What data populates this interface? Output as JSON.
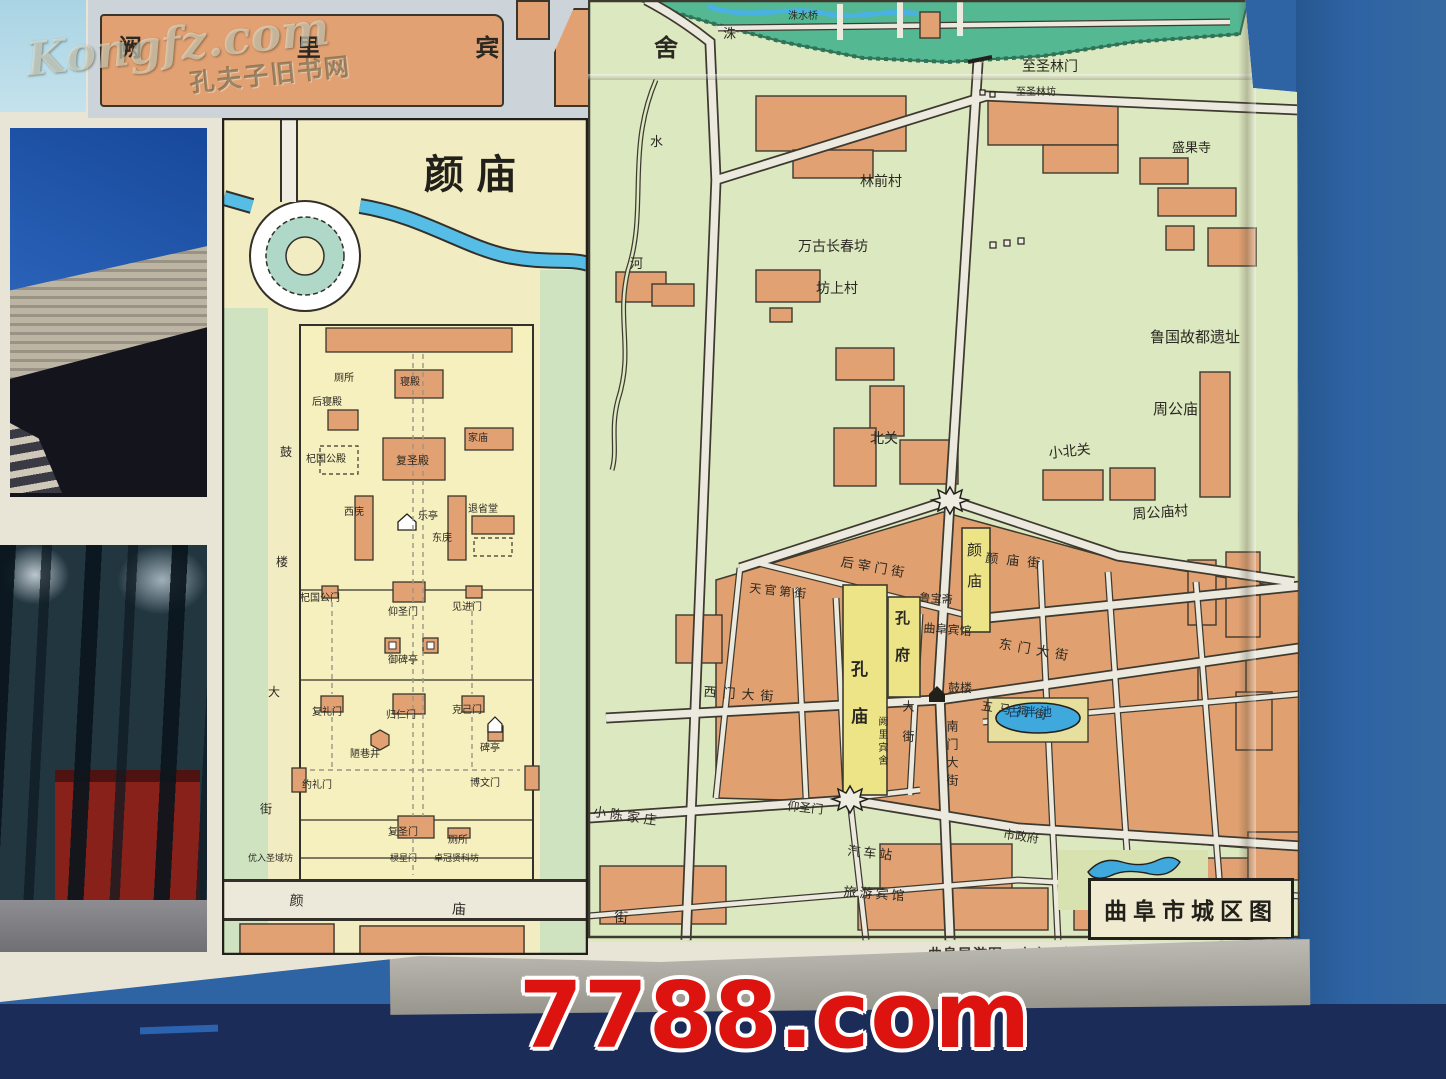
{
  "watermarks": {
    "bookstore": "Kongfz.com",
    "bookstore_sub": "孔夫子旧书网",
    "marketplace": "7788.com"
  },
  "hotel_inset": {
    "label": "阙  里  宾  舍"
  },
  "yanmiao_inset": {
    "title": "颜庙",
    "labels": [
      {
        "t": "厕所",
        "x": 334,
        "y": 374,
        "s": 10
      },
      {
        "t": "寝殿",
        "x": 400,
        "y": 378,
        "s": 10
      },
      {
        "t": "后寝殿",
        "x": 312,
        "y": 398,
        "s": 10
      },
      {
        "t": "家庙",
        "x": 468,
        "y": 434,
        "s": 10
      },
      {
        "t": "杞国公殿",
        "x": 306,
        "y": 455,
        "s": 10
      },
      {
        "t": "复圣殿",
        "x": 396,
        "y": 455,
        "s": 11
      },
      {
        "t": "西庑",
        "x": 344,
        "y": 508,
        "s": 10
      },
      {
        "t": "乐亭",
        "x": 418,
        "y": 512,
        "s": 10
      },
      {
        "t": "退省堂",
        "x": 468,
        "y": 505,
        "s": 10
      },
      {
        "t": "东庑",
        "x": 432,
        "y": 534,
        "s": 10
      },
      {
        "t": "杞国公门",
        "x": 300,
        "y": 594,
        "s": 10
      },
      {
        "t": "仰圣门",
        "x": 388,
        "y": 608,
        "s": 10
      },
      {
        "t": "见进门",
        "x": 452,
        "y": 603,
        "s": 10
      },
      {
        "t": "御碑亭",
        "x": 388,
        "y": 656,
        "s": 10
      },
      {
        "t": "复礼门",
        "x": 312,
        "y": 708,
        "s": 10
      },
      {
        "t": "归仁门",
        "x": 386,
        "y": 711,
        "s": 10
      },
      {
        "t": "克己门",
        "x": 452,
        "y": 706,
        "s": 10
      },
      {
        "t": "陋巷井",
        "x": 350,
        "y": 750,
        "s": 10
      },
      {
        "t": "碑亭",
        "x": 480,
        "y": 744,
        "s": 10
      },
      {
        "t": "约礼门",
        "x": 302,
        "y": 781,
        "s": 10
      },
      {
        "t": "博文门",
        "x": 470,
        "y": 779,
        "s": 10
      },
      {
        "t": "复圣门",
        "x": 388,
        "y": 828,
        "s": 10
      },
      {
        "t": "厕所",
        "x": 448,
        "y": 836,
        "s": 10
      },
      {
        "t": "优入圣域坊",
        "x": 248,
        "y": 855,
        "s": 9
      },
      {
        "t": "棂星门",
        "x": 390,
        "y": 855,
        "s": 9
      },
      {
        "t": "卓冠贤科坊",
        "x": 434,
        "y": 855,
        "s": 9
      },
      {
        "t": "颜 庙 街",
        "x": 290,
        "y": 894,
        "s": 14,
        "ls": 72,
        "r": 3
      },
      {
        "t": "鼓",
        "x": 280,
        "y": 446,
        "s": 12
      },
      {
        "t": "楼",
        "x": 276,
        "y": 556,
        "s": 12
      },
      {
        "t": "大",
        "x": 268,
        "y": 686,
        "s": 12
      },
      {
        "t": "街",
        "x": 260,
        "y": 803,
        "s": 12
      }
    ]
  },
  "city_map": {
    "title": "曲阜市城区图",
    "caption": "曲阜导游图　山东画报社编　准印号 2—019　定价0.65元",
    "labels": [
      {
        "t": "洙",
        "x": 723,
        "y": 28,
        "s": 13
      },
      {
        "t": "水",
        "x": 650,
        "y": 136,
        "s": 13
      },
      {
        "t": "河",
        "x": 630,
        "y": 258,
        "s": 13
      },
      {
        "t": "洙水桥",
        "x": 788,
        "y": 12,
        "s": 10
      },
      {
        "t": "至圣林门",
        "x": 1022,
        "y": 60,
        "s": 14
      },
      {
        "t": "至圣林坊",
        "x": 1016,
        "y": 88,
        "s": 10
      },
      {
        "t": "林前村",
        "x": 860,
        "y": 175,
        "s": 14
      },
      {
        "t": "万古长春坊",
        "x": 798,
        "y": 240,
        "s": 14
      },
      {
        "t": "坊上村",
        "x": 816,
        "y": 282,
        "s": 14
      },
      {
        "t": "盛果寺",
        "x": 1172,
        "y": 142,
        "s": 13
      },
      {
        "t": "鲁国故都遗址",
        "x": 1150,
        "y": 330,
        "s": 15
      },
      {
        "t": "周公庙",
        "x": 1153,
        "y": 402,
        "s": 15
      },
      {
        "t": "北关",
        "x": 870,
        "y": 432,
        "s": 14
      },
      {
        "t": "小北关",
        "x": 1048,
        "y": 447,
        "s": 14,
        "r": -6
      },
      {
        "t": "周公庙村",
        "x": 1132,
        "y": 508,
        "s": 14,
        "r": -4
      },
      {
        "t": "颜庙",
        "x": 966,
        "y": 542,
        "s": 15,
        "v": 1,
        "ls": 16
      },
      {
        "t": "后宰门街",
        "x": 842,
        "y": 556,
        "s": 13,
        "r": 10,
        "ls": 4
      },
      {
        "t": "颜庙街",
        "x": 986,
        "y": 552,
        "s": 13,
        "r": 6,
        "ls": 8
      },
      {
        "t": "天官第街",
        "x": 750,
        "y": 582,
        "s": 12,
        "r": 6,
        "ls": 3
      },
      {
        "t": "鲁宝斋",
        "x": 920,
        "y": 592,
        "s": 11,
        "r": 4
      },
      {
        "t": "曲阜宾馆",
        "x": 924,
        "y": 622,
        "s": 12,
        "r": 4
      },
      {
        "t": "东门大街",
        "x": 1000,
        "y": 638,
        "s": 13,
        "r": 10,
        "ls": 6
      },
      {
        "t": "孔庙",
        "x": 848,
        "y": 660,
        "s": 17,
        "v": 1,
        "ls": 30,
        "b": 1
      },
      {
        "t": "孔府",
        "x": 894,
        "y": 610,
        "s": 15,
        "v": 1,
        "ls": 22,
        "b": 1
      },
      {
        "t": "鼓楼",
        "x": 948,
        "y": 682,
        "s": 12
      },
      {
        "t": "西门大街",
        "x": 704,
        "y": 686,
        "s": 13,
        "r": 4,
        "ls": 6
      },
      {
        "t": "五马祠街",
        "x": 982,
        "y": 700,
        "s": 12,
        "r": 8,
        "ls": 6
      },
      {
        "t": "阙里宾舍",
        "x": 876,
        "y": 716,
        "s": 10,
        "v": 1,
        "ls": 3
      },
      {
        "t": "大街",
        "x": 902,
        "y": 700,
        "s": 12,
        "v": 1,
        "ls": 18
      },
      {
        "t": "南门大街",
        "x": 946,
        "y": 720,
        "s": 12,
        "v": 1,
        "ls": 6
      },
      {
        "t": "古泮池",
        "x": 1008,
        "y": 706,
        "s": 12,
        "ls": 4,
        "c": "#133a66"
      },
      {
        "t": "仰圣门",
        "x": 788,
        "y": 800,
        "s": 12,
        "r": 6
      },
      {
        "t": "小陈家庄",
        "x": 594,
        "y": 806,
        "s": 13,
        "r": 8,
        "ls": 4
      },
      {
        "t": "市政府",
        "x": 1004,
        "y": 828,
        "s": 12,
        "r": 8
      },
      {
        "t": "汽车站",
        "x": 848,
        "y": 845,
        "s": 13,
        "r": 6,
        "ls": 3
      },
      {
        "t": "旅游宾馆",
        "x": 844,
        "y": 886,
        "s": 13,
        "r": 4,
        "ls": 3
      }
    ],
    "colors": {
      "map_bg": "#dce8c0",
      "building_orange": "#e2a173",
      "landmark_yellow": "#ece487",
      "water_blue": "#3fa8dc",
      "forest_green": "#54b893",
      "watermark_red": "#dd1310"
    }
  }
}
